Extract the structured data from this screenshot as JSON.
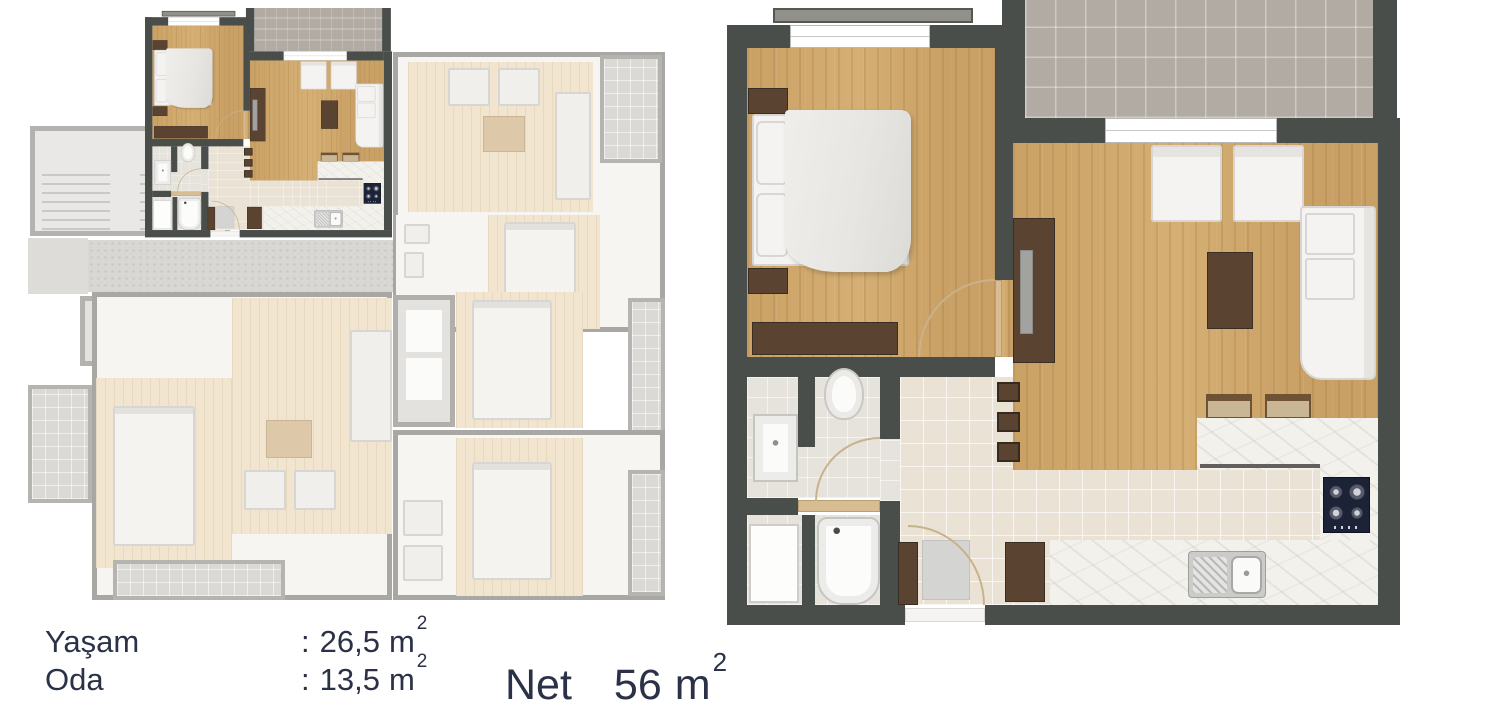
{
  "legend": {
    "rows": [
      {
        "label": "Yaşam",
        "colon": ":",
        "value": "26,5",
        "unit": "m",
        "sup": "2"
      },
      {
        "label": "Oda",
        "colon": ":",
        "value": "13,5",
        "unit": "m",
        "sup": "2"
      }
    ],
    "net": {
      "label": "Net",
      "value": "56",
      "unit": "m",
      "sup": "2"
    }
  },
  "colors": {
    "wall_dark": "#4a4e4b",
    "wood": "#cfa76b",
    "tile_hall": "#eae2d4",
    "balcony_tile": "#b2aba3",
    "bath_tile": "#e6e3dd",
    "marble": "#f3f1ec",
    "furniture_dark": "#5a4431",
    "door_tan": "#d8bd92",
    "stove_navy": "#1d2337",
    "fabric_white": "#f4f3f1",
    "duvet_gray": "#e9e8e4",
    "text_navy": "#2b3147",
    "faded_wall": "#a8a7a4",
    "faded_wood": "#f1e5cf",
    "faded_floor": "#f6f5f2",
    "faded_gray": "#dbd9d5",
    "corridor_gray": "#d9d7d3"
  }
}
